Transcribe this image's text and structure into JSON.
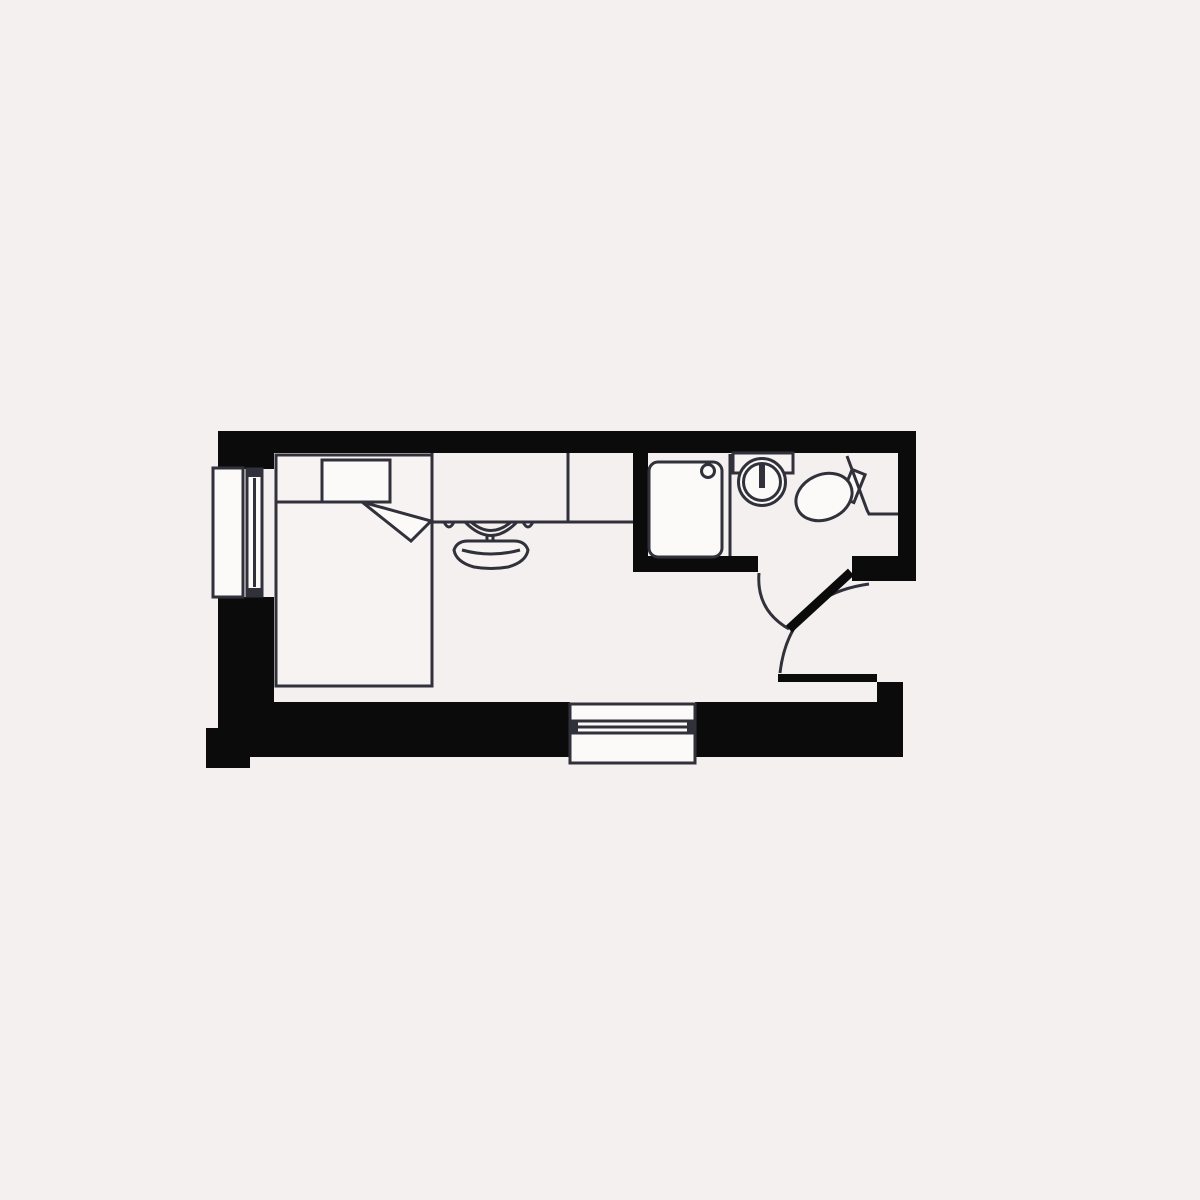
{
  "title": "studio-room-floor-plan",
  "colors": {
    "background": "#f4f0ef",
    "wall": "#0b0b0b",
    "line": "#31313b",
    "fixture": "#f6f3f2",
    "white": "#fbfaf9"
  },
  "fixtures": [
    "bed",
    "pillow",
    "duvet-fold",
    "desk",
    "desk-chair",
    "window-left",
    "window-bottom",
    "shower-tray",
    "shower-drain",
    "shower-screen",
    "washbasin",
    "vanity-shelf",
    "toilet",
    "service-duct",
    "bathroom-door",
    "entrance-door"
  ],
  "rooms_count": 2,
  "doors_count": 2,
  "windows_count": 2
}
